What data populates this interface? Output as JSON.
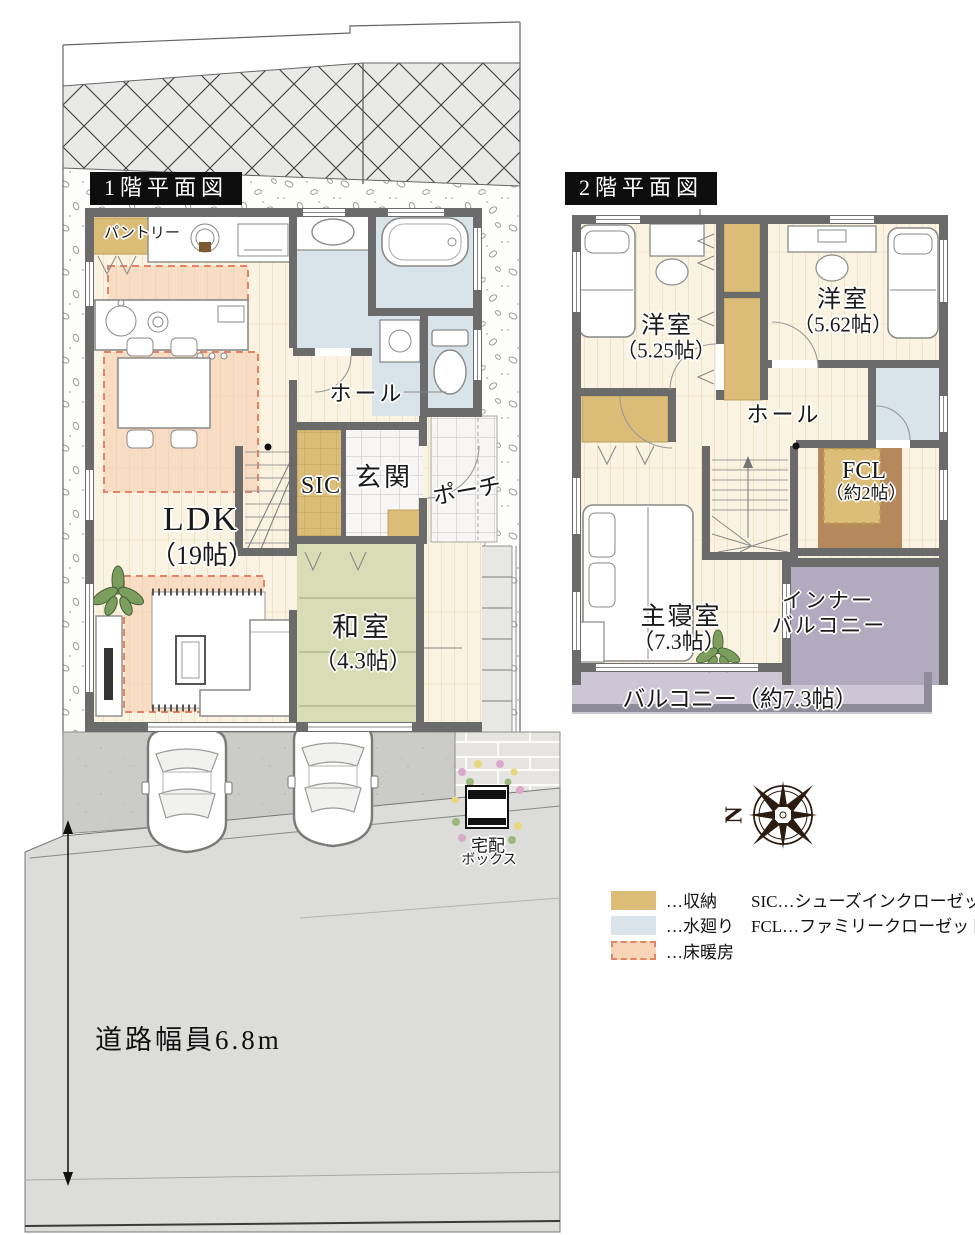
{
  "floor1": {
    "title": "1階平面図",
    "labels": {
      "pantry": "パントリー",
      "hall": "ホール",
      "sic": "SIC",
      "genkan": "玄関",
      "porch": "ポーチ",
      "ldk_name": "LDK",
      "ldk_size": "（19帖）",
      "washitsu_name": "和室",
      "washitsu_size": "（4.3帖）"
    },
    "delivery_box_line1": "宅配",
    "delivery_box_line2": "ボックス",
    "road_width": "道路幅員6.8m"
  },
  "floor2": {
    "title": "2階平面図",
    "labels": {
      "room1_name": "洋室",
      "room1_size": "（5.25帖）",
      "room2_name": "洋室",
      "room2_size": "（5.62帖）",
      "hall": "ホール",
      "fcl_name": "FCL",
      "fcl_size": "（約2帖）",
      "master_name": "主寝室",
      "master_size": "（7.3帖）",
      "inner_balcony_line1": "インナー",
      "inner_balcony_line2": "バルコニー",
      "balcony": "バルコニー（約7.3帖）"
    }
  },
  "legend": {
    "items": [
      {
        "label": "…収納",
        "color": "#dcbd78",
        "style": "solid"
      },
      {
        "label": "…水廻り",
        "color": "#dbe4ea",
        "style": "solid"
      },
      {
        "label": "…床暖房",
        "color": "#f7d4b6",
        "border": "#dd8668",
        "style": "dashed"
      }
    ],
    "abbreviations": [
      "SIC…シューズインクローゼット",
      "FCL…ファミリークローゼット"
    ]
  },
  "compass": {
    "north": "N"
  }
}
